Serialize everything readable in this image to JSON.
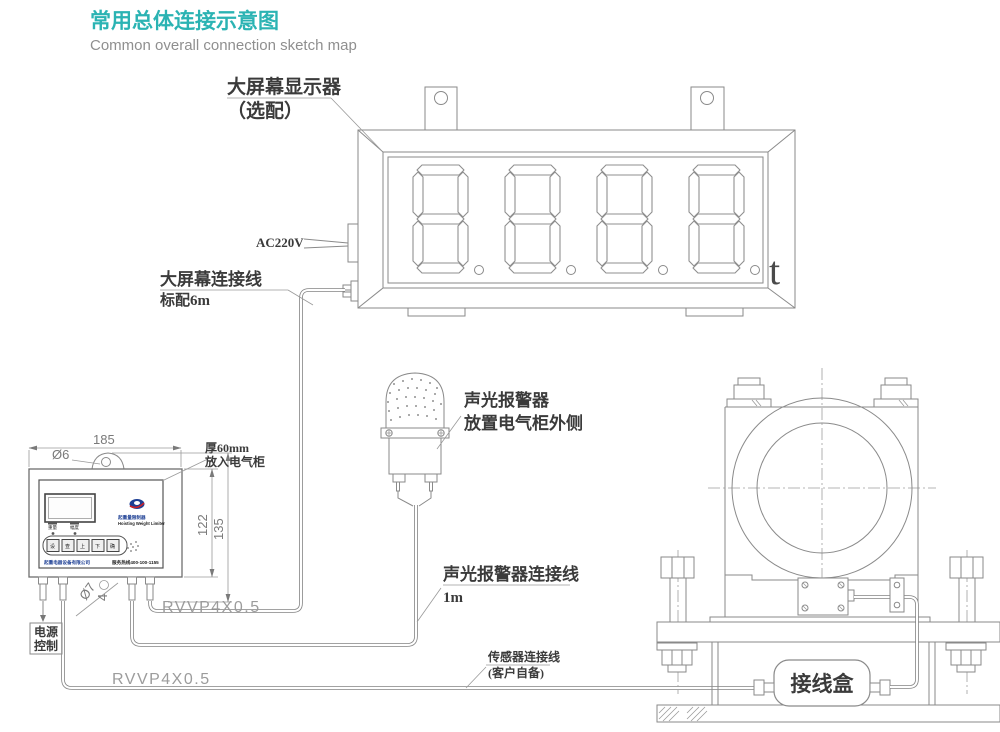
{
  "title": {
    "cn": "常用总体连接示意图",
    "en": "Common overall connection sketch map"
  },
  "labels": {
    "display_name": "大屏幕显示器",
    "display_optional": "（选配）",
    "ac_power": "AC220V",
    "display_cable": "大屏幕连接线",
    "display_cable_len": "标配6m",
    "unit": "t",
    "alarm_name": "声光报警器",
    "alarm_place": "放置电气柜外侧",
    "alarm_cable": "声光报警器连接线",
    "alarm_cable_len": "1m",
    "sensor_cable": "传感器连接线",
    "sensor_cable_note": "(客户自备)",
    "junction_box": "接线盒",
    "cable_spec_display": "RVVP4X0.5",
    "cable_spec_sensor": "RVVP4X0.5",
    "power_ctrl_l1": "电源",
    "power_ctrl_l2": "控制",
    "thickness": "厚60mm",
    "cabinet_note": "放入电气柜"
  },
  "dims": {
    "width": "185",
    "hole": "Ø6",
    "panel_height": "122",
    "total_height": "135",
    "gland": "Ø7",
    "gland_count": "4"
  },
  "panel": {
    "model_cn": "起重量限制器",
    "model_en": "Hoisting Weight Limiter",
    "company": "起重电器设备有限公司",
    "hotline": "服务热线400-100-1155",
    "ind1": "重量",
    "ind2": "幅度",
    "buttons": [
      "设",
      "查",
      "上",
      "下",
      "确"
    ]
  },
  "colors": {
    "accent": "#2bb3b3",
    "line": "#8a8a8a",
    "logo_blue": "#1d3f94",
    "logo_red": "#c8222a"
  }
}
